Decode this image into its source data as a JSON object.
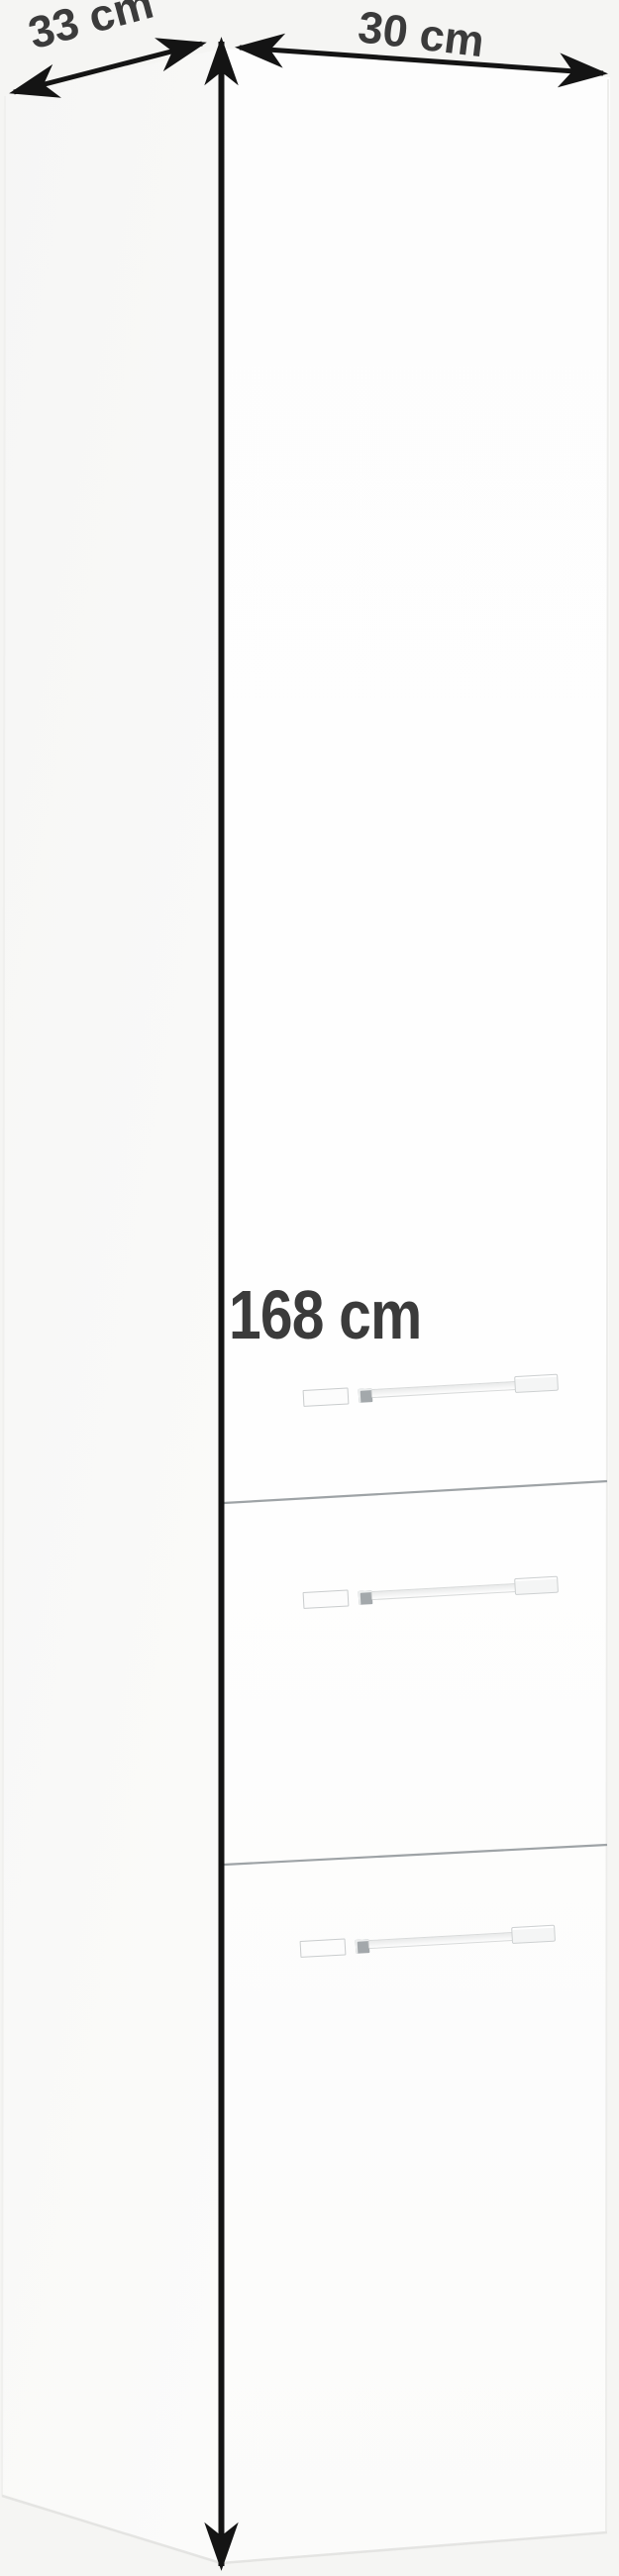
{
  "product_diagram": {
    "type": "furniture-dimension-diagram",
    "item": "tall-white-bathroom-cabinet",
    "depth_label": "33 cm",
    "width_label": "30 cm",
    "height_label": "168 cm",
    "doors": [
      "top-door",
      "middle-door",
      "bottom-door"
    ],
    "handle_count": 3
  },
  "colors": {
    "background": "#f5f5f3",
    "cabinet_white": "#fdfdfd",
    "annotation_text": "#3b3b3b",
    "arrow_black": "#141414",
    "seam_gray": "#9ea3a6",
    "handle_outline": "#cdd0d1"
  }
}
